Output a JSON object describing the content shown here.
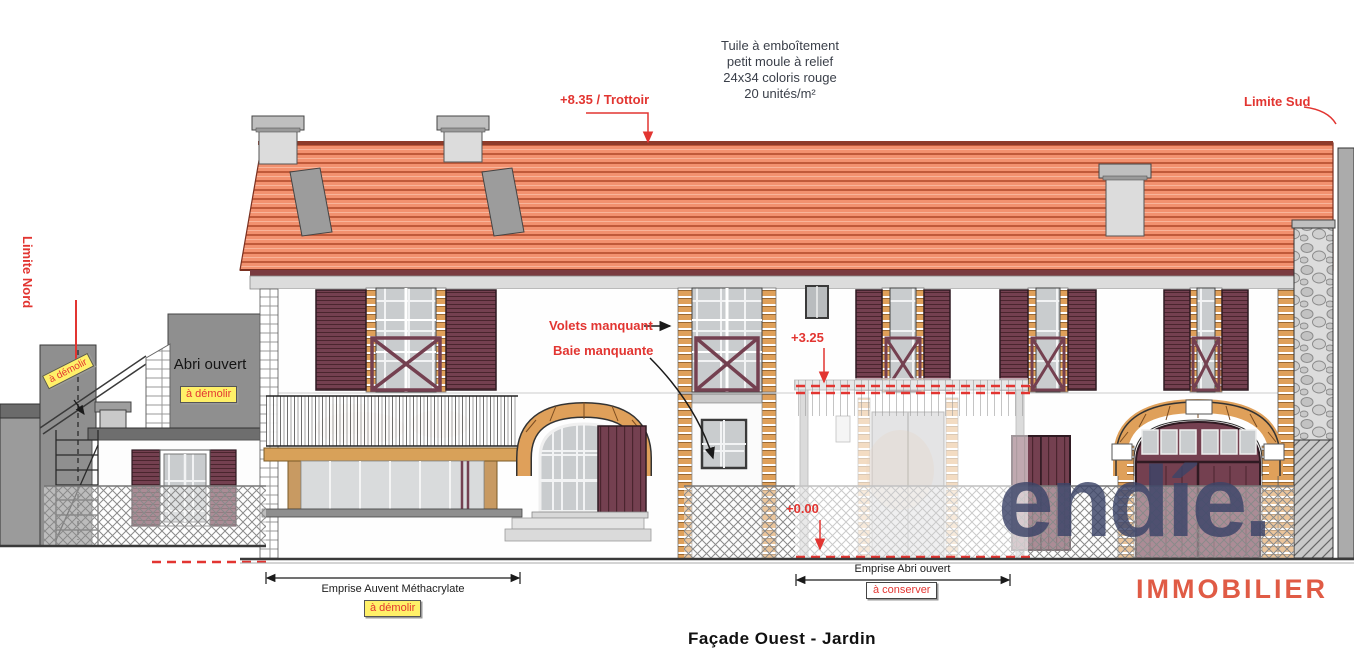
{
  "drawing": {
    "title": "Façade Ouest - Jardin",
    "roof_note_lines": [
      "Tuile à emboîtement",
      "petit moule à relief",
      "24x34 coloris rouge",
      "20 unités/m²"
    ],
    "levels": {
      "ridge": "+8.35 / Trottoir",
      "floor": "+3.25",
      "ground": "+0.00"
    },
    "boundaries": {
      "north": "Limite Nord",
      "south": "Limite Sud"
    },
    "labels": {
      "abri_ouvert": "Abri ouvert",
      "volets_manquant": "Volets manquant",
      "baie_manquante": "Baie manquante"
    },
    "tags": {
      "demolish_annex": "à démolir",
      "demolish_annex_rotated": "à démolir",
      "demolish_awning": "à démolir",
      "keep_shelter": "à conserver"
    },
    "dimensions": {
      "awning": "Emprise Auvent Méthacrylate",
      "shelter": "Emprise Abri ouvert"
    },
    "colors": {
      "annotation_red": "#e23531",
      "tag_yellow": "#fff068",
      "roof_tile": "#f2916f",
      "shutter_maroon": "#744050",
      "brick_tan": "#dfa05a",
      "logo_navy": "#3c4468",
      "logo_coral": "#e05b45"
    }
  },
  "logo": {
    "wordmark": "endíe.",
    "subtitle": "IMMOBILIER"
  }
}
